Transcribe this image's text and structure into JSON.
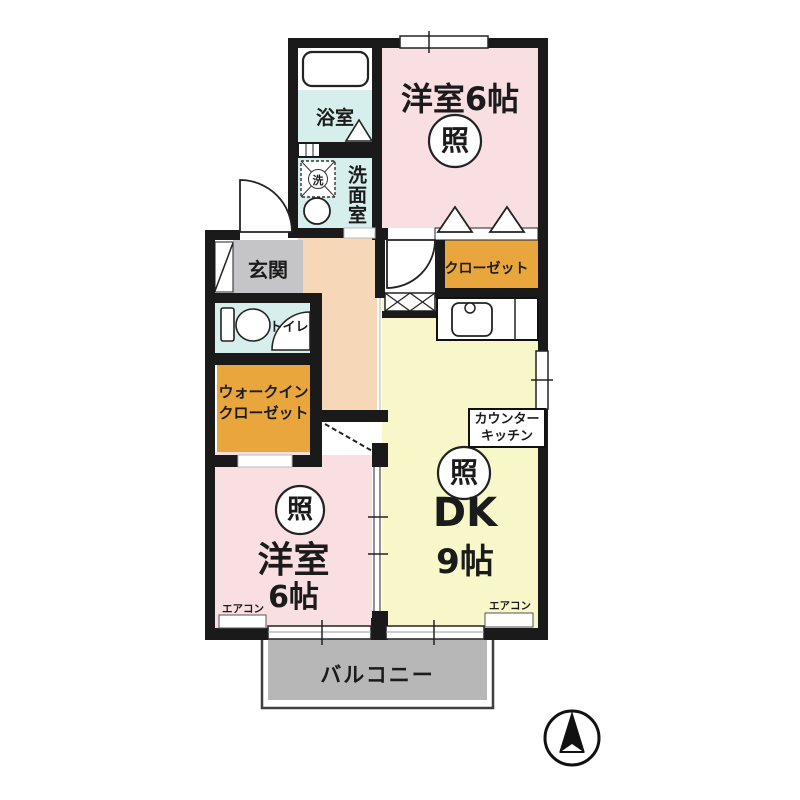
{
  "floorplan": {
    "rooms": {
      "bedroom_top": {
        "label": "洋室6帖",
        "light_symbol": "照"
      },
      "bath": {
        "label": "浴室"
      },
      "washroom": {
        "label": "洗面室",
        "washer_mark": "洗"
      },
      "entrance": {
        "label": "玄関"
      },
      "toilet": {
        "label": "トイレ"
      },
      "closet": {
        "label": "クローゼット"
      },
      "walkin_closet": {
        "label_line1": "ウォークイン",
        "label_line2": "クローゼット"
      },
      "dk": {
        "label": "DK",
        "size_label": "9帖",
        "light_symbol": "照",
        "counter_line1": "カウンター",
        "counter_line2": "キッチン"
      },
      "bedroom_bottom": {
        "label": "洋室",
        "size_label": "6帖",
        "light_symbol": "照"
      },
      "balcony": {
        "label": "バルコニー"
      }
    },
    "equipment": {
      "aircon_left": "エアコン",
      "aircon_right": "エアコン"
    },
    "colors": {
      "wall": "#1a1a1a",
      "bedroom_pink": "#f9dee2",
      "dk_yellow": "#f8f7c9",
      "closet_orange": "#e9a63c",
      "wet_area_cyan": "#d6efec",
      "hallway_peach": "#f6d7b8",
      "entrance_gray": "#c5c5c7",
      "balcony_gray": "#b7b7b7"
    },
    "compass": {
      "meaning": "north-arrow"
    }
  }
}
